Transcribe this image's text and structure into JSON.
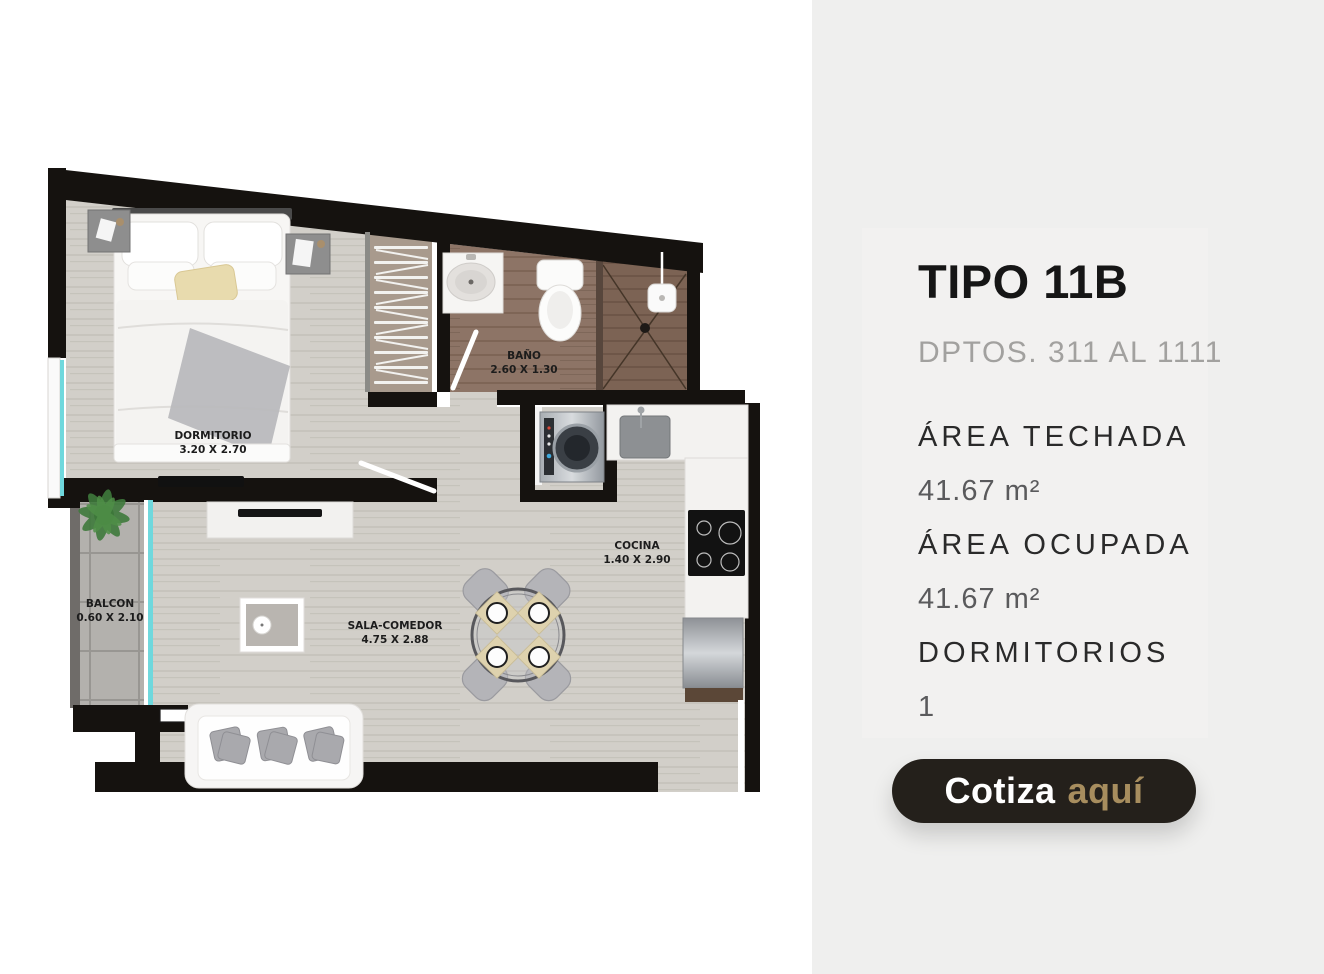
{
  "floorplan": {
    "rooms": [
      {
        "name": "DORMITORIO",
        "dims": "3.20 X 2.70"
      },
      {
        "name": "BAÑO",
        "dims": "2.60 X 1.30"
      },
      {
        "name": "COCINA",
        "dims": "1.40 X 2.90"
      },
      {
        "name": "SALA-COMEDOR",
        "dims": "4.75 X 2.88"
      },
      {
        "name": "BALCON",
        "dims": "0.60 X 2.10"
      }
    ],
    "colors": {
      "wall": "#15120f",
      "wood_floor": "#d2cfc9",
      "bath_floor": "#8d7466",
      "shower_floor": "#7c6354",
      "balcony_floor": "#b3b1ad",
      "glass": "#6fd8dd"
    }
  },
  "panel": {
    "background": "#efefee",
    "title": "TIPO 11B",
    "subtitle": "DPTOS. 311 AL 1111",
    "specs": [
      {
        "label": "ÁREA TECHADA",
        "value": "41.67 m²"
      },
      {
        "label": "ÁREA OCUPADA",
        "value": "41.67 m²"
      },
      {
        "label": "DORMITORIOS",
        "value": "1"
      }
    ],
    "cta": {
      "label_primary": "Cotiza",
      "label_accent": "aquí",
      "background": "#24201b",
      "accent_color": "#a78d5e"
    }
  }
}
